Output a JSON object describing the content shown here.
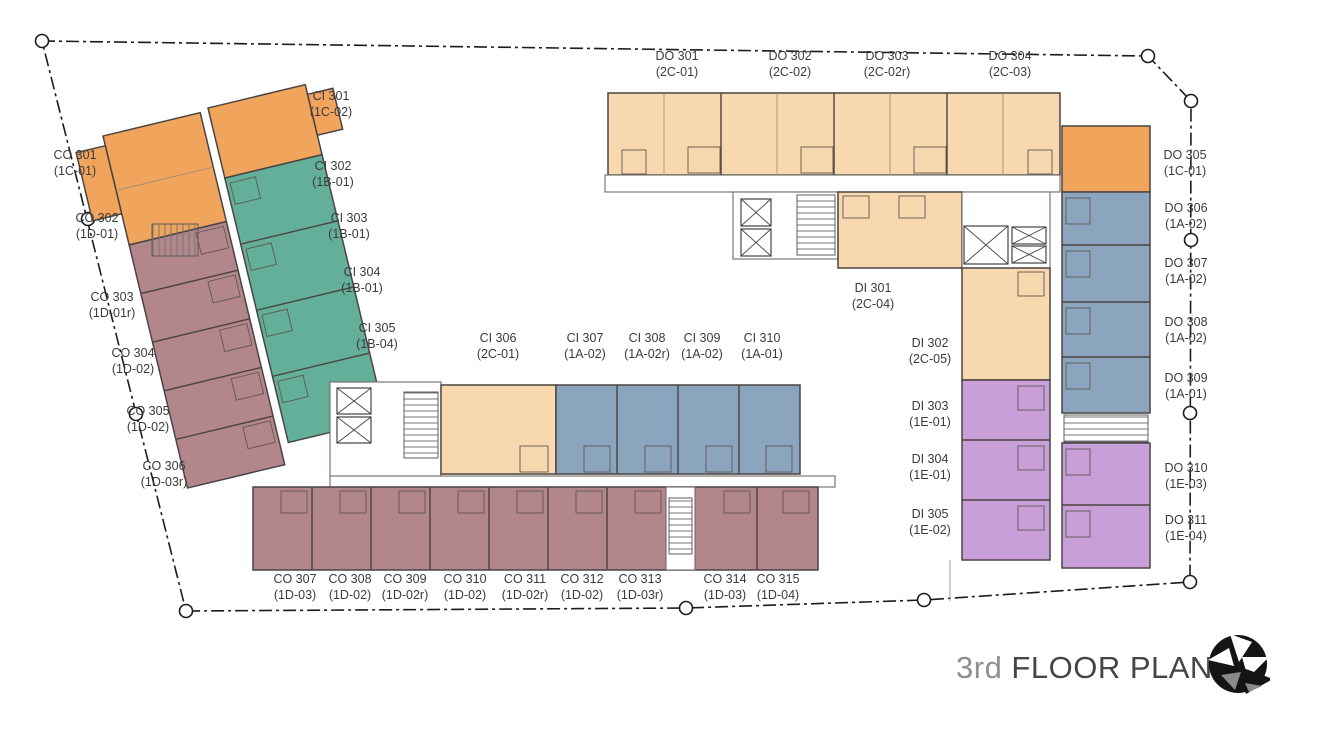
{
  "title": {
    "floor": "3rd",
    "label": " FLOOR PLAN"
  },
  "colors": {
    "peach": "#f8d8ae",
    "orange": "#f0a45c",
    "mauve": "#b3868c",
    "teal": "#63af9a",
    "blue": "#8aa5bd",
    "purple": "#c89fd8",
    "outline": "#4a4443",
    "boundary": "#1c1c1c",
    "label_text": "#3b3b3b"
  },
  "unit_labels": [
    {
      "name": "DO 301",
      "type": "(2C-01)",
      "color": "peach",
      "x": 677,
      "y": 49
    },
    {
      "name": "DO 302",
      "type": "(2C-02)",
      "color": "peach",
      "x": 790,
      "y": 49
    },
    {
      "name": "DO 303",
      "type": "(2C-02r)",
      "color": "peach",
      "x": 887,
      "y": 49
    },
    {
      "name": "DO 304",
      "type": "(2C-03)",
      "color": "peach",
      "x": 1010,
      "y": 49
    },
    {
      "name": "CO 301",
      "type": "(1C-01)",
      "color": "orange",
      "x": 75,
      "y": 148
    },
    {
      "name": "CO 302",
      "type": "(1D-01)",
      "color": "mauve",
      "x": 97,
      "y": 211
    },
    {
      "name": "CO 303",
      "type": "(1D-01r)",
      "color": "mauve",
      "x": 112,
      "y": 290
    },
    {
      "name": "CO 304",
      "type": "(1D-02)",
      "color": "mauve",
      "x": 133,
      "y": 346
    },
    {
      "name": "CO 305",
      "type": "(1D-02)",
      "color": "mauve",
      "x": 148,
      "y": 404
    },
    {
      "name": "CO 306",
      "type": "(1D-03r)",
      "color": "mauve",
      "x": 164,
      "y": 459
    },
    {
      "name": "CI 301",
      "type": "(1C-02)",
      "color": "orange",
      "x": 331,
      "y": 89
    },
    {
      "name": "CI 302",
      "type": "(1B-01)",
      "color": "teal",
      "x": 333,
      "y": 159
    },
    {
      "name": "CI 303",
      "type": "(1B-01)",
      "color": "teal",
      "x": 349,
      "y": 211
    },
    {
      "name": "CI 304",
      "type": "(1B-01)",
      "color": "teal",
      "x": 362,
      "y": 265
    },
    {
      "name": "CI 305",
      "type": "(1B-04)",
      "color": "teal",
      "x": 377,
      "y": 321
    },
    {
      "name": "CI 306",
      "type": "(2C-01)",
      "color": "peach",
      "x": 498,
      "y": 331
    },
    {
      "name": "CI 307",
      "type": "(1A-02)",
      "color": "blue",
      "x": 585,
      "y": 331
    },
    {
      "name": "CI 308",
      "type": "(1A-02r)",
      "color": "blue",
      "x": 647,
      "y": 331
    },
    {
      "name": "CI 309",
      "type": "(1A-02)",
      "color": "blue",
      "x": 702,
      "y": 331
    },
    {
      "name": "CI 310",
      "type": "(1A-01)",
      "color": "blue",
      "x": 762,
      "y": 331
    },
    {
      "name": "DI 301",
      "type": "(2C-04)",
      "color": "peach",
      "x": 873,
      "y": 281
    },
    {
      "name": "DI 302",
      "type": "(2C-05)",
      "color": "peach",
      "x": 930,
      "y": 336
    },
    {
      "name": "DI 303",
      "type": "(1E-01)",
      "color": "purple",
      "x": 930,
      "y": 399
    },
    {
      "name": "DI 304",
      "type": "(1E-01)",
      "color": "purple",
      "x": 930,
      "y": 452
    },
    {
      "name": "DI 305",
      "type": "(1E-02)",
      "color": "purple",
      "x": 930,
      "y": 507
    },
    {
      "name": "DO 305",
      "type": "(1C-01)",
      "color": "orange",
      "x": 1185,
      "y": 148
    },
    {
      "name": "DO 306",
      "type": "(1A-02)",
      "color": "blue",
      "x": 1186,
      "y": 201
    },
    {
      "name": "DO 307",
      "type": "(1A-02)",
      "color": "blue",
      "x": 1186,
      "y": 256
    },
    {
      "name": "DO 308",
      "type": "(1A-02)",
      "color": "blue",
      "x": 1186,
      "y": 315
    },
    {
      "name": "DO 309",
      "type": "(1A-01)",
      "color": "blue",
      "x": 1186,
      "y": 371
    },
    {
      "name": "DO 310",
      "type": "(1E-03)",
      "color": "purple",
      "x": 1186,
      "y": 461
    },
    {
      "name": "DO 311",
      "type": "(1E-04)",
      "color": "purple",
      "x": 1186,
      "y": 513
    },
    {
      "name": "CO 307",
      "type": "(1D-03)",
      "color": "mauve",
      "x": 295,
      "y": 572
    },
    {
      "name": "CO 308",
      "type": "(1D-02)",
      "color": "mauve",
      "x": 350,
      "y": 572
    },
    {
      "name": "CO 309",
      "type": "(1D-02r)",
      "color": "mauve",
      "x": 405,
      "y": 572
    },
    {
      "name": "CO 310",
      "type": "(1D-02)",
      "color": "mauve",
      "x": 465,
      "y": 572
    },
    {
      "name": "CO 311",
      "type": "(1D-02r)",
      "color": "mauve",
      "x": 525,
      "y": 572
    },
    {
      "name": "CO 312",
      "type": "(1D-02)",
      "color": "mauve",
      "x": 582,
      "y": 572
    },
    {
      "name": "CO 313",
      "type": "(1D-03r)",
      "color": "mauve",
      "x": 640,
      "y": 572
    },
    {
      "name": "CO 314",
      "type": "(1D-03)",
      "color": "mauve",
      "x": 725,
      "y": 572
    },
    {
      "name": "CO 315",
      "type": "(1D-04)",
      "color": "mauve",
      "x": 778,
      "y": 572
    }
  ]
}
